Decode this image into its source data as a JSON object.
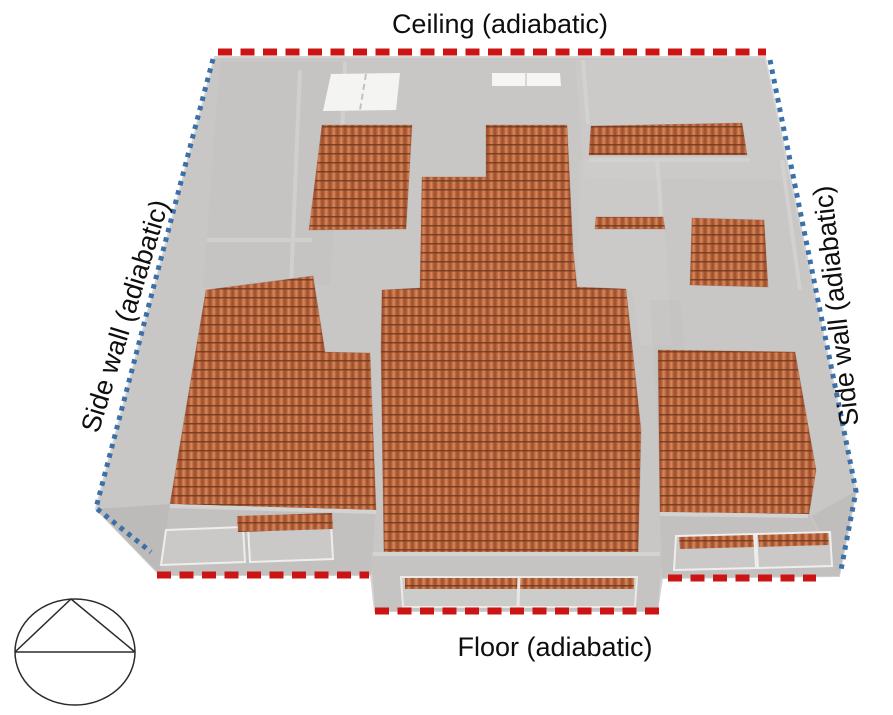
{
  "boundaries": {
    "ceiling": {
      "label": "Ceiling (adiabatic)",
      "line": "dashed",
      "color": "#cd1414"
    },
    "floor": {
      "label": "Floor (adiabatic)",
      "line": "dashed",
      "color": "#cd1414"
    },
    "side_wall_left": {
      "label": "Side wall (adiabatic)",
      "line": "dotted",
      "color": "#3b70a9"
    },
    "side_wall_right": {
      "label": "Side wall (adiabatic)",
      "line": "dotted",
      "color": "#3b70a9"
    }
  },
  "colors": {
    "ceiling_floor_boundary": "#cd1414",
    "side_wall_boundary": "#3b70a9",
    "floor_tile_light": "#d98a5c",
    "floor_tile_mid": "#b4613b",
    "floor_tile_dark": "#703a20",
    "building_gray": "#c8c7c5",
    "skylight_white": "#f4f4f2"
  },
  "icons": {
    "north_indicator": "circle-inscribed-triangle-north-symbol"
  }
}
